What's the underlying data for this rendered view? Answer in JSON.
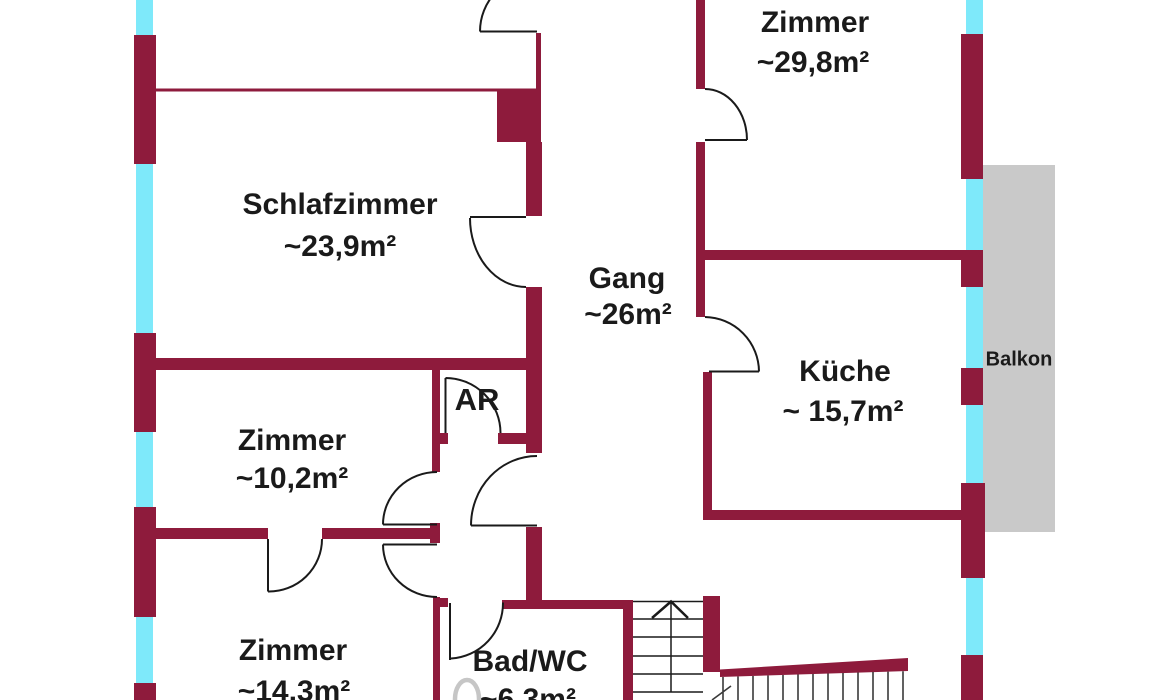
{
  "plan_type": "floorplan",
  "colors": {
    "wall": "#8E1B3C",
    "window": "#7EE9FA",
    "balcony": "#C9C9C9",
    "text": "#1A1A1A",
    "fixture": "#C6C6C6"
  },
  "rooms": {
    "schlafzimmer": {
      "name": "Schlafzimmer",
      "area": "~23,9m²"
    },
    "zimmer_29": {
      "name": "Zimmer",
      "area": "~29,8m²"
    },
    "gang": {
      "name": "Gang",
      "area": "~26m²"
    },
    "kueche": {
      "name": "Küche",
      "area": "~ 15,7m²"
    },
    "zimmer_10": {
      "name": "Zimmer",
      "area": "~10,2m²"
    },
    "zimmer_14": {
      "name": "Zimmer",
      "area": "~14,3m²"
    },
    "bad": {
      "name": "Bad/WC",
      "area": "~6,3m²"
    },
    "ar": {
      "name": "AR"
    },
    "balkon": {
      "name": "Balkon"
    }
  }
}
